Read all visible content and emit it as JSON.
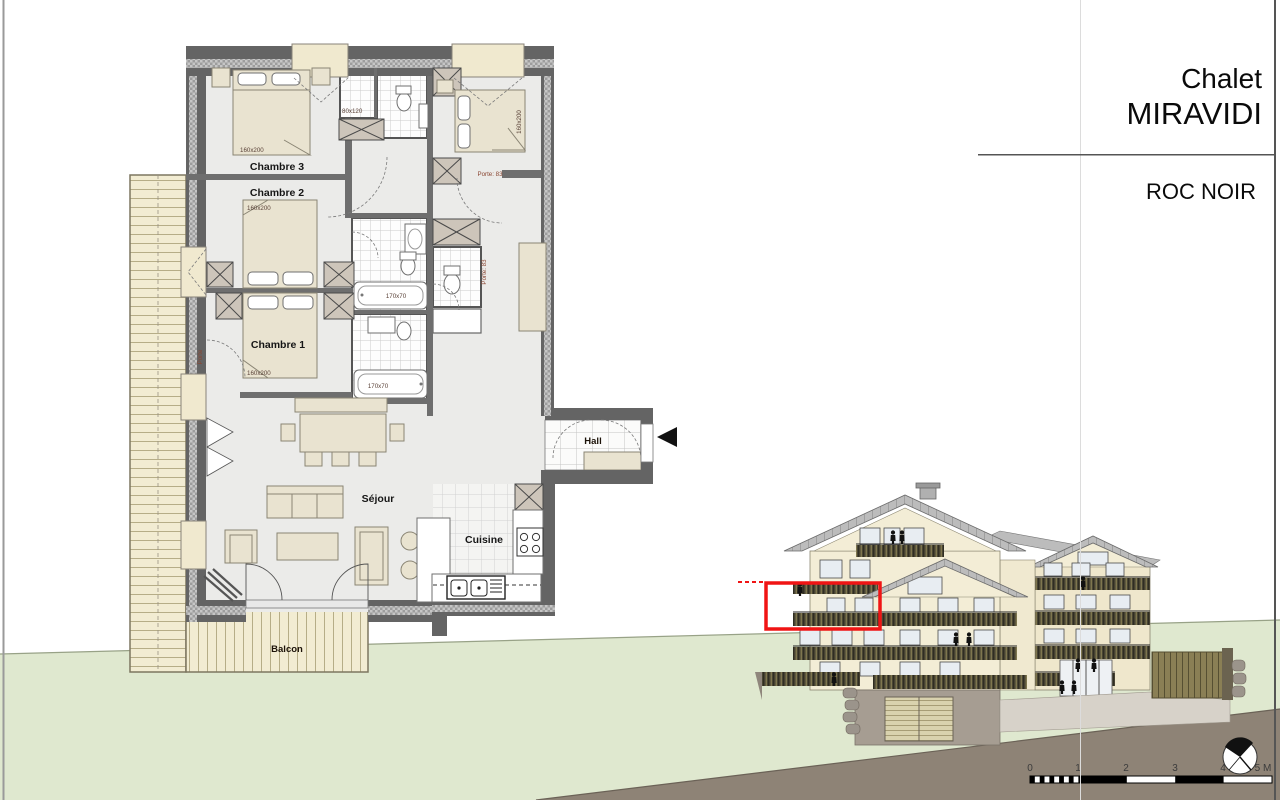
{
  "title_block": {
    "project": "Chalet",
    "name": "MIRAVIDI",
    "building": "ROC NOIR"
  },
  "plan": {
    "rooms": {
      "chambre3": "Chambre 3",
      "chambre2": "Chambre 2",
      "chambre1": "Chambre 1",
      "sejour": "Séjour",
      "cuisine": "Cuisine",
      "hall": "Hall",
      "balcon": "Balcon"
    },
    "dims": {
      "bed3": "160x200",
      "bed2": "160x200",
      "bed1": "160x200",
      "bed_tr": "160x200",
      "shower": "80x120",
      "tub_upper": "170x70",
      "tub_lower": "170x70"
    },
    "doors": {
      "tr": "Porte: 83",
      "wc": "Porte: 83",
      "left": "Porte"
    }
  },
  "scale_bar": {
    "labels": [
      "0",
      "1",
      "2",
      "3",
      "4",
      "5 M"
    ]
  },
  "colors": {
    "highlight_red": "#f01414",
    "grass_green": "#dfe8cf",
    "earth_brown": "#8e8376",
    "wall_gray": "#646464",
    "wood_cream": "#f2ecd2",
    "roof_gray": "#bcbcbc"
  }
}
